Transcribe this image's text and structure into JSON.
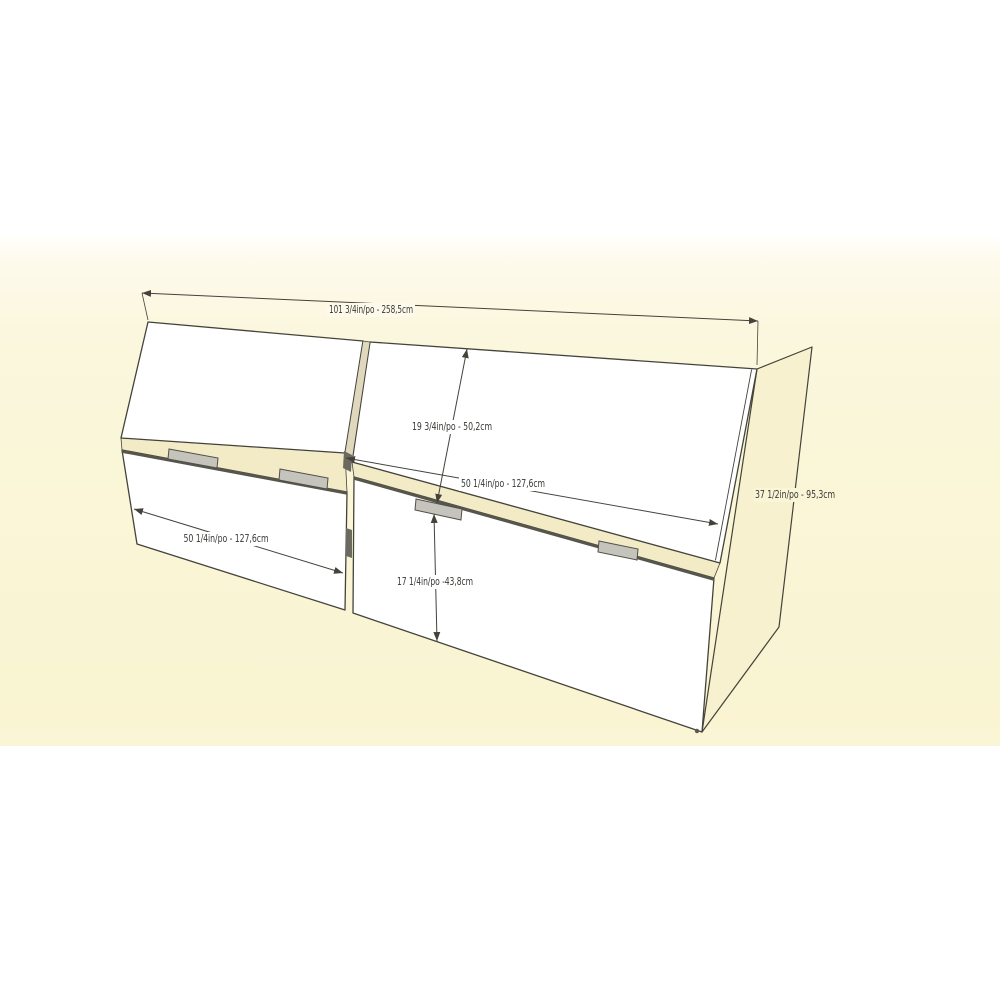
{
  "diagram": {
    "title": "storage headboard dimension drawing",
    "style": "3d-perspective-line-render",
    "background_band_color": "#FBF6DC",
    "outline_color": "#44433B",
    "door_color": "#FFFFFF",
    "interior_shelf_color": "#F2EBC6",
    "side_panel_color": "#F8F1CF",
    "hinge_color": "#C4C3BC",
    "labels": {
      "total_width": "101 3/4in/po - 258,5cm",
      "upper_door_height": "19 3/4in/po - 50,2cm",
      "upper_door_width": "50 1/4in/po - 127,6cm",
      "lower_door_width": "50 1/4in/po - 127,6cm",
      "lower_door_height": "17 1/4in/po -43,8cm",
      "unit_height": "37 1/2in/po - 95,3cm"
    }
  }
}
